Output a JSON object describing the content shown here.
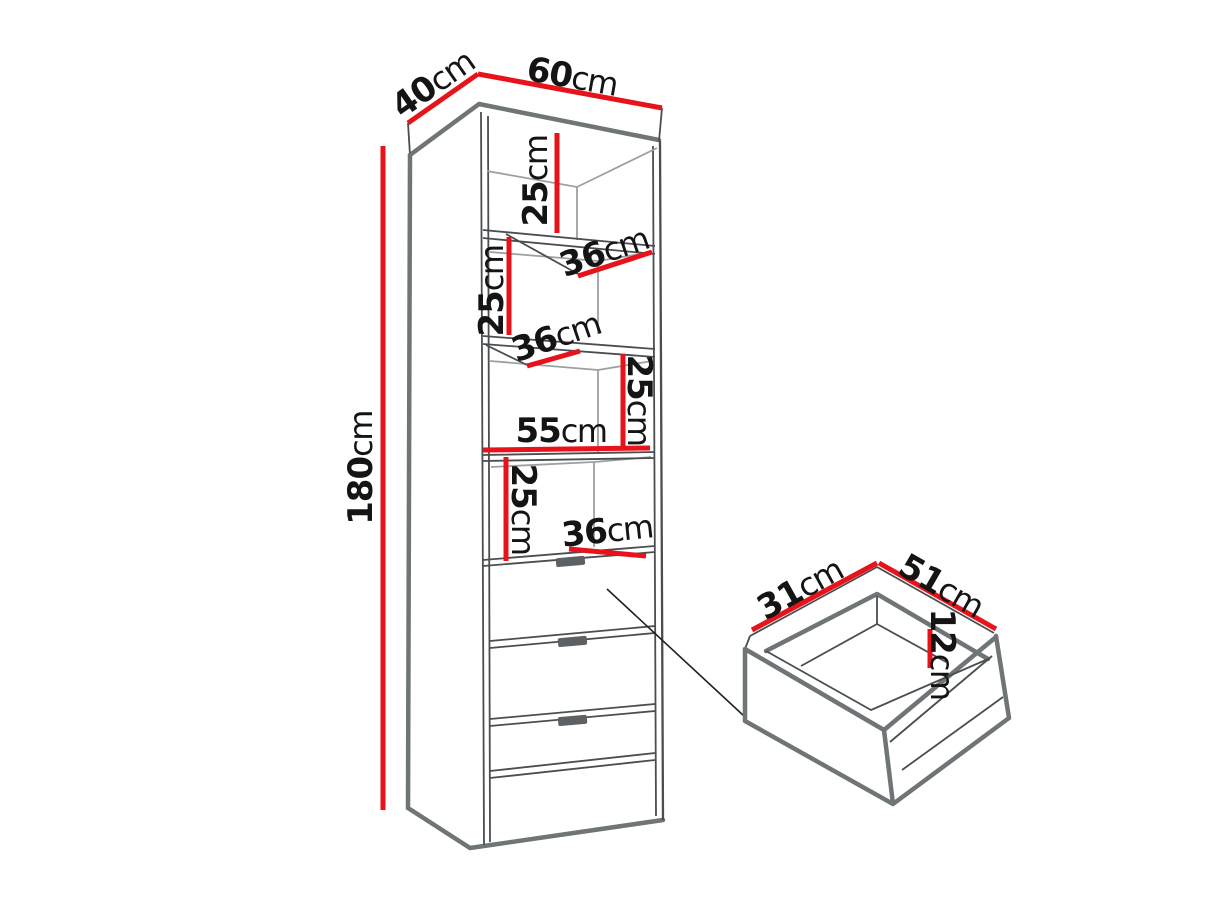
{
  "diagram": {
    "type": "furniture-dimension-diagram",
    "subject": "tall cabinet with 3 shelves and 3 drawers, plus detail view of one drawer",
    "background": "#ffffff",
    "colors": {
      "dimension_line": "#e8131a",
      "outline_thick": "#6f7476",
      "outline_thin": "#4a4e50",
      "interior_line": "#9ba0a3",
      "text": "#141414",
      "handle": "#5d6164"
    },
    "cabinet": {
      "depth": "40cm",
      "width": "60cm",
      "height": "180cm",
      "inner_width": "55cm",
      "section_heights": [
        "25cm",
        "25cm",
        "25cm",
        "25cm"
      ],
      "shelf_depths": [
        "36cm",
        "36cm",
        "36cm"
      ],
      "drawer_count": 3
    },
    "drawer_detail": {
      "depth": "31cm",
      "width": "51cm",
      "inner_height": "12cm"
    }
  },
  "labels": [
    {
      "id": "cabinet-depth",
      "value": "40",
      "unit": "cm"
    },
    {
      "id": "cabinet-width",
      "value": "60",
      "unit": "cm"
    },
    {
      "id": "cabinet-height",
      "value": "180",
      "unit": "cm"
    },
    {
      "id": "section1-height",
      "value": "25",
      "unit": "cm"
    },
    {
      "id": "shelf1-depth",
      "value": "36",
      "unit": "cm"
    },
    {
      "id": "section2-height",
      "value": "25",
      "unit": "cm"
    },
    {
      "id": "shelf2-depth",
      "value": "36",
      "unit": "cm"
    },
    {
      "id": "section3-height",
      "value": "25",
      "unit": "cm"
    },
    {
      "id": "inner-width",
      "value": "55",
      "unit": "cm"
    },
    {
      "id": "section4-height",
      "value": "25",
      "unit": "cm"
    },
    {
      "id": "shelf3-depth",
      "value": "36",
      "unit": "cm"
    },
    {
      "id": "drawer-depth",
      "value": "31",
      "unit": "cm"
    },
    {
      "id": "drawer-width",
      "value": "51",
      "unit": "cm"
    },
    {
      "id": "drawer-inner-height",
      "value": "12",
      "unit": "cm"
    }
  ]
}
